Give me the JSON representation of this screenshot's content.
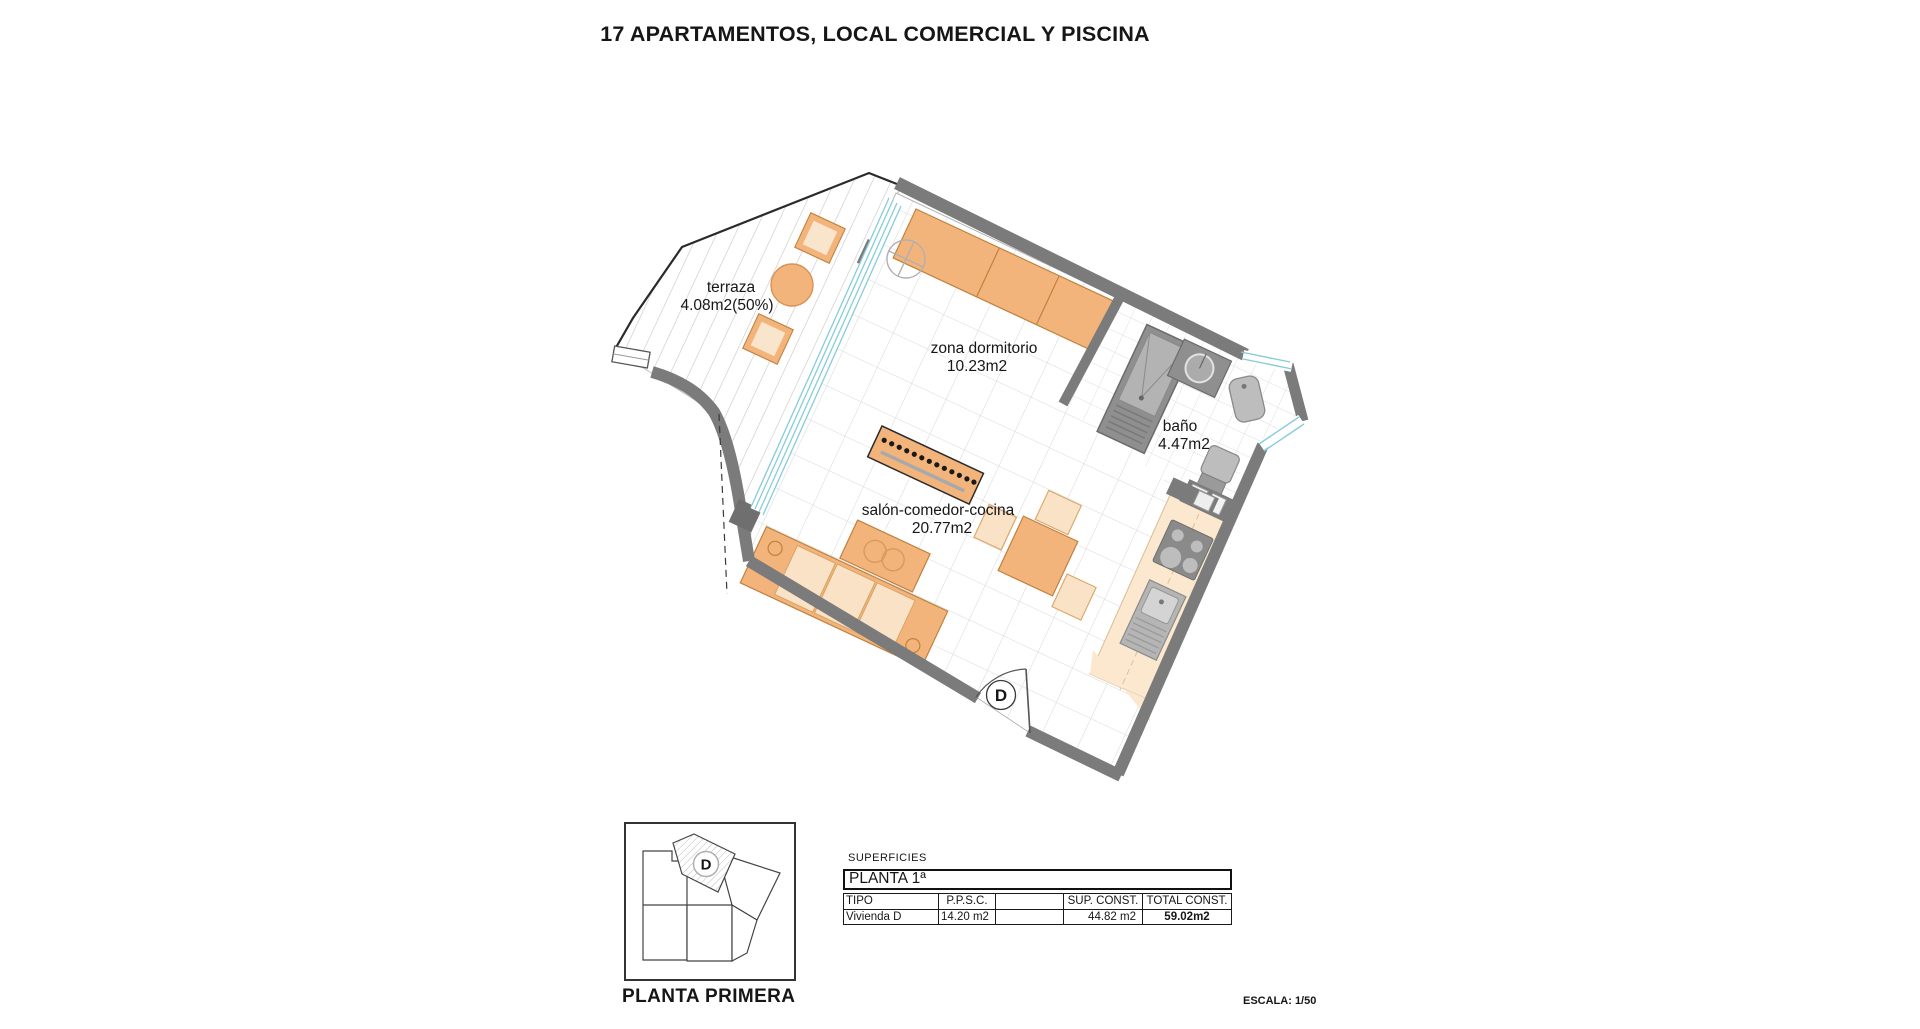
{
  "title": "17 APARTAMENTOS, LOCAL COMERCIAL Y PISCINA",
  "plan": {
    "entrance_label": "D",
    "rooms": [
      {
        "name": "terraza",
        "area": "4.08m2(50%)"
      },
      {
        "name": "zona dormitorio",
        "area": "10.23m2"
      },
      {
        "name": "baño",
        "area": "4.47m2"
      },
      {
        "name": "salón-comedor-cocina",
        "area": "20.77m2"
      }
    ]
  },
  "key_plan": {
    "unit_label": "D",
    "caption": "PLANTA PRIMERA"
  },
  "surfaces_table": {
    "section_label": "SUPERFICIES",
    "floor_label": "PLANTA 1ª",
    "columns": [
      "TIPO",
      "P.P.S.C.",
      "",
      "SUP. CONST.",
      "TOTAL CONST."
    ],
    "row": {
      "tipo": "Vivienda D",
      "ppsc": "14.20 m2",
      "empty": "",
      "sup_const": "44.82 m2",
      "total_const": "59.02m2"
    }
  },
  "scale_label": "ESCALA: 1/50",
  "colors": {
    "wall": "#7b7b7b",
    "glass": "#86ccd9",
    "furniture_orange": "#f3b47c",
    "furniture_light": "#f9e2c6",
    "counter": "#fbe8cf",
    "shower_gray": "#8f8f8f",
    "fixture_gray": "#bdbdbd"
  }
}
